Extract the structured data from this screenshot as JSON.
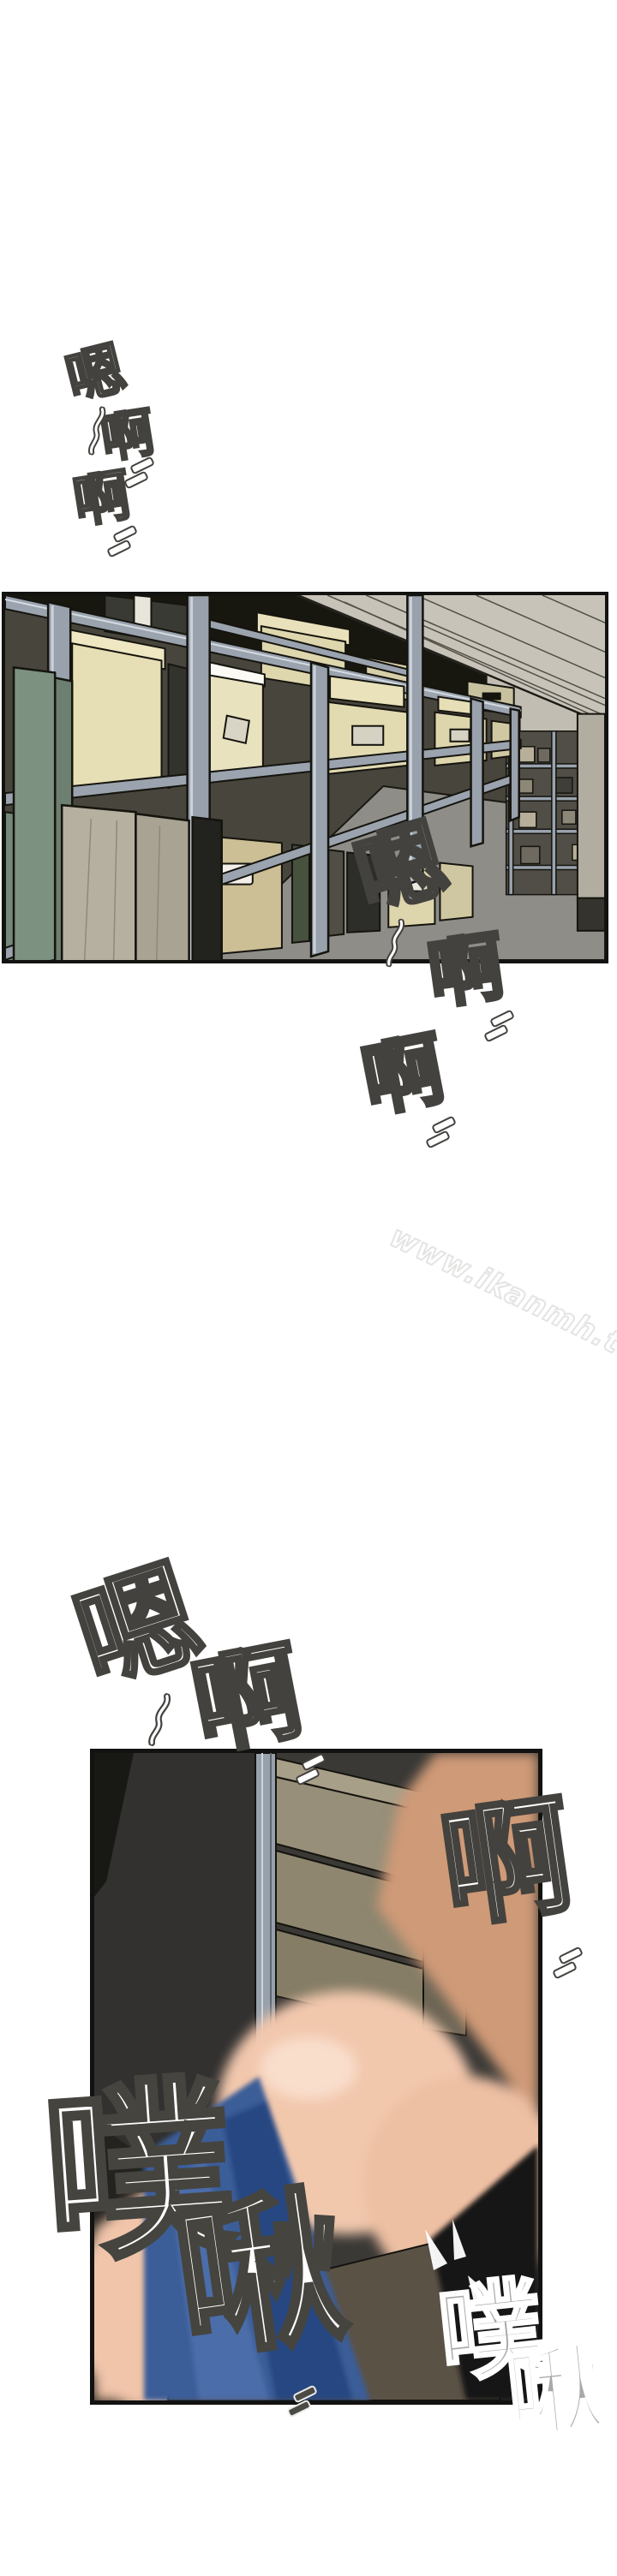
{
  "page_type": "comic-page",
  "watermark": {
    "text": "www.ikanmh.top"
  },
  "sfx": {
    "top": {
      "chars": [
        "嗯",
        "啊",
        "啊"
      ]
    },
    "middle": {
      "chars": [
        "嗯",
        "啊",
        "啊"
      ]
    },
    "third": {
      "chars": [
        "嗯",
        "啊",
        "啊"
      ]
    },
    "bottom_left": {
      "chars": [
        "噗",
        "啾"
      ]
    },
    "bottom_right": {
      "chars": [
        "噗",
        "啾"
      ]
    }
  },
  "panels": [
    {
      "name": "storage-room-panel"
    },
    {
      "name": "closeup-panel"
    }
  ],
  "palette": {
    "paper": "#ffffff",
    "ink": "#121210",
    "sfx_outline": "#43423e",
    "shelf_metal": "#9aa3ae",
    "box_cream": "#e5ddb4",
    "ceiling_gray": "#c8c3b9",
    "floor_gray": "#8e8d88",
    "cabinet_tan": "#c1b48e",
    "skin_light": "#f2c8ad",
    "skin_tan": "#cf9a77",
    "fabric_blue": "#3b5d98",
    "wood_brown": "#5b5246",
    "stocking_black": "#161614",
    "watermark_gray": "#e4e4e3"
  }
}
